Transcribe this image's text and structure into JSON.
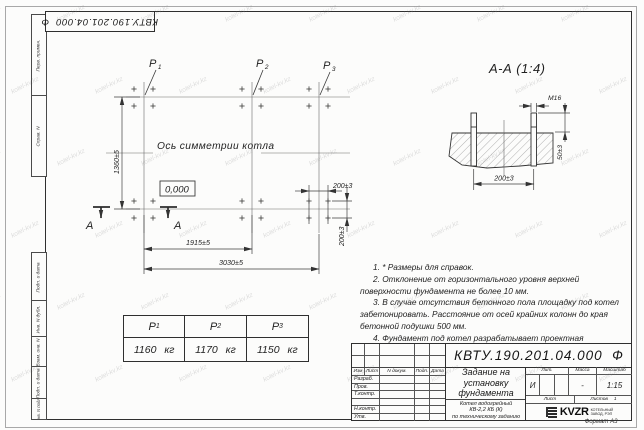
{
  "page": {
    "format_label": "Формат А3",
    "watermark": "kotel-kv.kz"
  },
  "margin_labels": {
    "perv_primen": "Перв. примен.",
    "sprav_n": "Справ. N",
    "podp_data_top": "Подп. и дата",
    "inv_dubl": "Инв. N дубл.",
    "vzam_inv": "Взам. инв. N",
    "podp_data_bottom": "Подп. и дата",
    "inv_podl": "Инв. N подл."
  },
  "plan": {
    "p_labels": [
      {
        "base": "P",
        "sub": "1"
      },
      {
        "base": "P",
        "sub": "2"
      },
      {
        "base": "P",
        "sub": "3"
      }
    ],
    "axis_text": "Ось симметрии котла",
    "elevation": "0,000",
    "section_letter": "А",
    "dims": {
      "height": "1360±5",
      "span_p1_p2": "1915±5",
      "total": "3030±5",
      "bolt_pitch_h": "200±3",
      "bolt_pitch_v": "200±3"
    }
  },
  "section": {
    "title": "А-А (1:4)",
    "dims": {
      "thread": "М16",
      "protrusion": "50±3",
      "pitch": "200±3"
    }
  },
  "notes": [
    "1. * Размеры для справок.",
    "2. Отклонение от горизонтального уровня верхней поверхности фундамента не более 10 мм.",
    "3. В случае отсутствия бетонного пола площадку под котел забетонировать. Расстояние от осей крайних колонн до края бетонной подушки 500 мм.",
    "4. Фундамент под котел разрабатывает проектная организация по нагрузкам на фундамент."
  ],
  "load_table": {
    "headers": [
      {
        "base": "P",
        "sub": "1"
      },
      {
        "base": "P",
        "sub": "2"
      },
      {
        "base": "P",
        "sub": "3"
      }
    ],
    "values": [
      "1160 кг",
      "1170 кг",
      "1150 кг"
    ]
  },
  "title_block": {
    "doc_number": "КВТУ.190.201.04.000  Ф",
    "title_lines": [
      "Задание на",
      "установку",
      "фундамента"
    ],
    "subtitle_lines": [
      "Котел водогрейный",
      "КВ-2,2 КБ (К)",
      "по техническому заданию"
    ],
    "header_cells": [
      "Изм",
      "Лист",
      "N докум.",
      "Подп.",
      "Дата"
    ],
    "sign_rows": [
      "Разраб.",
      "Пров.",
      "Т.контр.",
      "",
      "Н.контр.",
      "Утв."
    ],
    "lit_label": "Лит.",
    "lit_value": "И",
    "mass_label": "Масса",
    "mass_value": "-",
    "scale_label": "Масштаб",
    "scale_value": "1:15",
    "sheet_label": "Лист",
    "sheets_label": "Листов",
    "sheets_value": "1",
    "company": {
      "abbr": "KVZR",
      "name_line1": "КОТЕЛЬНЫЙ",
      "name_line2": "ЗАВОД, РЭП"
    }
  }
}
